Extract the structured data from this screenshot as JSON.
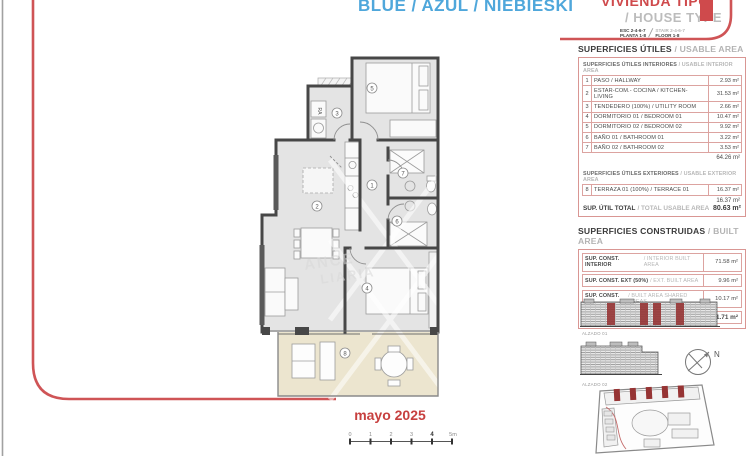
{
  "header": {
    "title_blue": "BLUE / AZUL / NIEBIESKI",
    "title_red": "VIVIENDA TIPO",
    "subtitle": "/ HOUSE TYPE",
    "esc_line1": "ESC 2-4-6-7",
    "esc_line2": "PLANTA 1-8",
    "stair_line1": "STAIR 2-4-6-7",
    "stair_line2": "FLOOR 1-8"
  },
  "usable": {
    "heading_es": "SUPERFICIES ÚTILES",
    "heading_en": "/ USABLE AREA",
    "interior_heading_es": "SUPERFICIES ÚTILES INTERIORES",
    "interior_heading_en": "/ USABLE INTERIOR AREA",
    "interior_rows": [
      {
        "num": "1",
        "label": "PASO / HALLWAY",
        "value": "2.93 m²"
      },
      {
        "num": "2",
        "label": "ESTAR-COM.- COCINA / KITCHEN-LIVING",
        "value": "31.53 m²"
      },
      {
        "num": "3",
        "label": "TENDEDERO (100%) / UTILITY ROOM",
        "value": "2.66 m²"
      },
      {
        "num": "4",
        "label": "DORMITORIO 01 / BEDROOM 01",
        "value": "10.47 m²"
      },
      {
        "num": "5",
        "label": "DORMITORIO 02 / BEDROOM 02",
        "value": "9.92 m²"
      },
      {
        "num": "6",
        "label": "BAÑO 01 / BATHROOM 01",
        "value": "3.22 m²"
      },
      {
        "num": "7",
        "label": "BAÑO 02 / BATHROOM 02",
        "value": "3.53 m²"
      }
    ],
    "interior_total": "64.26 m²",
    "exterior_heading_es": "SUPERFICIES ÚTILES EXTERIORES",
    "exterior_heading_en": "/ USABLE EXTERIOR AREA",
    "exterior_rows": [
      {
        "num": "8",
        "label": "TERRAZA 01 (100%) / TERRACE 01",
        "value": "16.37 m²"
      }
    ],
    "exterior_total": "16.37 m²",
    "total_label_es": "SUP. ÚTIL TOTAL",
    "total_label_en": "/ TOTAL USABLE AREA",
    "total_value": "80.63 m²"
  },
  "built": {
    "heading_es": "SUPERFICIES CONSTRUIDAS",
    "heading_en": "/ BUILT AREA",
    "rows": [
      {
        "label_es": "SUP. CONST. INTERIOR",
        "label_en": "/ INTERIOR BUILT AREA",
        "value": "71.58 m²"
      },
      {
        "label_es": "SUP. CONST. EXT (50%)",
        "label_en": "/ EXT. BUILT AREA",
        "value": "9.96 m²"
      },
      {
        "label_es": "SUP. CONST. Z/C",
        "label_en": "/ BUILT AREA SHARED AREAS",
        "value": "10.17 m²"
      },
      {
        "label_es": "SUP. CONS. TOTAL",
        "label_en": "/ TOTAL BUILT AREA",
        "value": "91.71 m²"
      }
    ]
  },
  "elevations": {
    "alzado1": "ALZADO 01",
    "alzado2": "ALZADO 02"
  },
  "compass": {
    "label": "N"
  },
  "footer": {
    "date": "mayo 2025"
  },
  "scalebar": {
    "ticks": [
      "0",
      "1",
      "2",
      "3",
      "4",
      "5m"
    ]
  },
  "plan": {
    "rooms": [
      "1",
      "2",
      "3",
      "4",
      "5",
      "6",
      "7",
      "8"
    ],
    "washer_label": "RA"
  },
  "watermark": {
    "line1": "ANCE",
    "line2": "LIARIA"
  },
  "colors": {
    "accent_red": "#cf5456",
    "accent_blue": "#4fa7db",
    "table_border": "#d99693",
    "highlight_red": "#963434",
    "terrace_fill": "#ece5cf"
  }
}
